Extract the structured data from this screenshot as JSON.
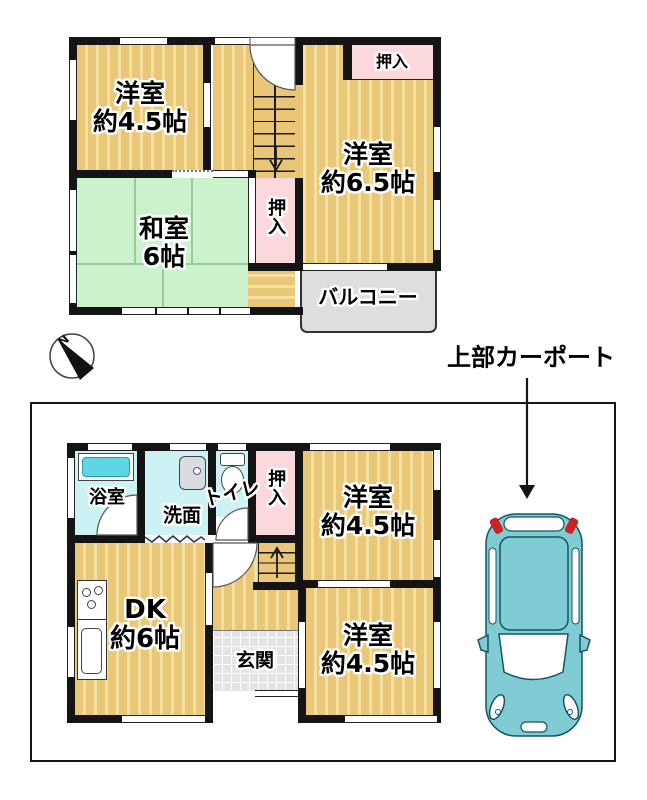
{
  "palette": {
    "wall": "#141414",
    "wood_floor": "#e9c678",
    "wood_stripe": "#f4e09e",
    "tatami_green": "#ccf2cc",
    "closet_pink": "#fbd8dc",
    "wet_area_cyan": "#cdf2f6",
    "bathtub_cyan": "#5fd6e6",
    "balcony_gray": "#dedede",
    "entry_tile_gray": "#e4e4e4",
    "car_teal": "#7fccd4",
    "tail_light_red": "#cc2222"
  },
  "floor2": {
    "room_nw": {
      "name": "洋室",
      "size": "約4.5帖"
    },
    "washitsu": {
      "name": "和室",
      "size": "6帖"
    },
    "room_e": {
      "name": "洋室",
      "size": "約6.5帖"
    },
    "closet_top": "押入",
    "closet_side": "押入",
    "balcony": "バルコニー"
  },
  "floor1": {
    "bath": "浴室",
    "wash": "洗面",
    "toilet": "トイレ",
    "closet": "押入",
    "room_ne": {
      "name": "洋室",
      "size": "約4.5帖"
    },
    "dk": {
      "name": "DK",
      "size": "約6帖"
    },
    "genkan": "玄関",
    "room_se": {
      "name": "洋室",
      "size": "約4.5帖"
    }
  },
  "compass": {
    "north": "N"
  },
  "carport": {
    "label": "上部カーポート"
  }
}
